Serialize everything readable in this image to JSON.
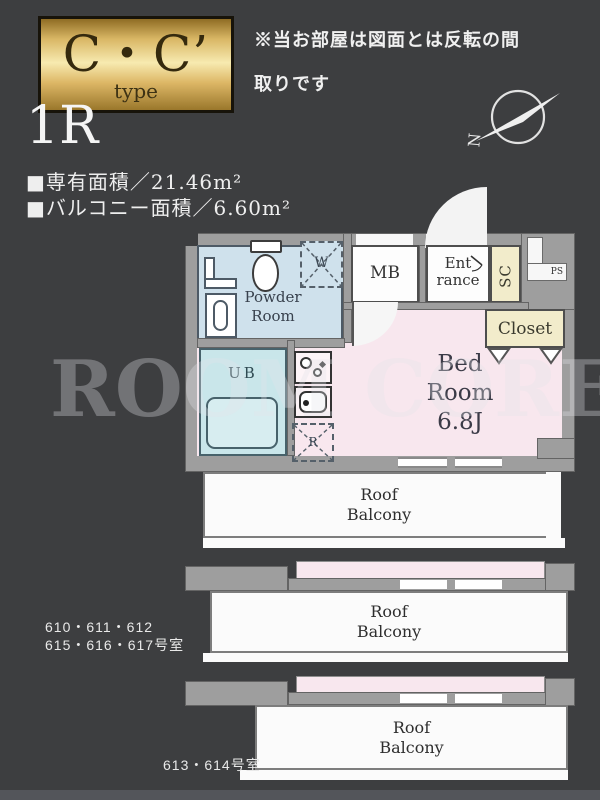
{
  "colors": {
    "bg": "#3d3e40",
    "wall": "#9e9e9e",
    "pink": "#f8e7ee",
    "blue": "#cfe1ec",
    "cyan": "#c9e6ea",
    "cream": "#f2eccb",
    "white": "#fbfbfb",
    "gold_light": "#f7eab0",
    "text": "#f0f0f0"
  },
  "header": {
    "type_label": "C・C’",
    "type_sub": "type",
    "notice_line1": "※当お部屋は図面とは反転の間",
    "notice_line2": "取りです",
    "plan_type": "1R",
    "area_line1": "■専有面積／21.46m²",
    "area_line2": "■バルコニー面積／6.60m²",
    "compass_letter": "N"
  },
  "plan": {
    "rooms": {
      "powder_line1": "Powder",
      "powder_line2": "Room",
      "mb": "MB",
      "entrance_line1": "Ent",
      "entrance_line2": "rance",
      "sc": "SC",
      "ps": "PS",
      "closet": "Closet",
      "bed_line1": "Bed",
      "bed_line2": "Room",
      "bed_line3": "6.8J",
      "ub": "UB",
      "washer": "W",
      "fridge": "R"
    }
  },
  "balconies": {
    "label_line1": "Roof",
    "label_line2": "Balcony"
  },
  "unit_labels": {
    "group1_line1": "610・611・612",
    "group1_line2": "615・616・617号室",
    "group2": "613・614号室"
  },
  "watermark": "ROOM CORE"
}
